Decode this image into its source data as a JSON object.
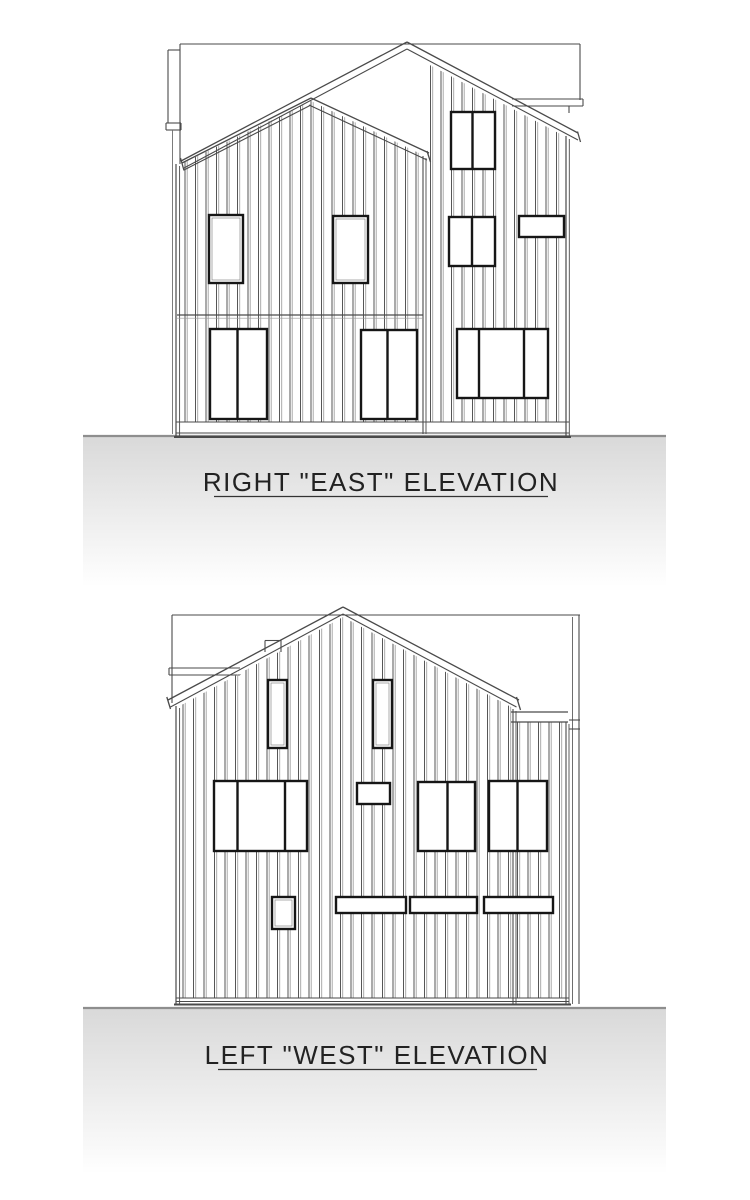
{
  "sheet": {
    "background": "#ffffff",
    "ink": "#4a4a4a",
    "frame_color": "#161616",
    "batten_dark": "#565656",
    "batten_light": "#a2a2a2",
    "ground_top_line": "#8e8e8e",
    "ground_fill_top": "#d9d9d9",
    "ground_fill_bottom": "#ffffff"
  },
  "elevations": [
    {
      "id": "east",
      "caption": "RIGHT \"EAST\" ELEVATION",
      "caption_pos": {
        "x": 381,
        "y": 491
      },
      "underline": [
        214,
        496.5,
        548,
        496.5
      ],
      "ground": {
        "x": 83,
        "y": 436,
        "w": 583,
        "h": 150
      },
      "back_lines": [
        [
          180,
          44,
          580,
          44
        ],
        [
          180,
          44,
          180,
          164
        ],
        [
          580,
          44,
          580,
          100
        ],
        [
          168,
          50,
          180,
          50
        ],
        [
          168,
          50,
          168,
          123
        ],
        [
          166,
          123,
          181,
          123
        ],
        [
          166,
          130,
          181,
          130
        ],
        [
          166,
          123,
          166,
          130
        ],
        [
          181,
          123,
          181,
          130
        ],
        [
          172.5,
          130,
          172.5,
          434,
          0.9,
          "#6e6e6e"
        ],
        [
          512,
          99,
          583,
          99
        ],
        [
          512,
          106,
          583,
          106
        ],
        [
          583,
          99,
          583,
          106
        ],
        [
          569,
          106,
          569,
          113
        ]
      ],
      "walls": [
        [
          [
            177,
            168
          ],
          [
            311,
            103
          ],
          [
            425,
            158
          ],
          [
            425,
            434
          ],
          [
            177,
            434
          ]
        ],
        [
          [
            314,
            99
          ],
          [
            407,
            51
          ],
          [
            566,
            136
          ],
          [
            566,
            434
          ],
          [
            425,
            434
          ],
          [
            425,
            150
          ]
        ]
      ],
      "siding": [
        {
          "clip": [
            [
              177,
              166
            ],
            [
              311,
              101
            ],
            [
              425,
              156
            ],
            [
              425,
              422
            ],
            [
              177,
              422
            ]
          ],
          "x0": 185,
          "x1": 419,
          "step": 10.5
        },
        {
          "clip": [
            [
              316,
              100
            ],
            [
              407,
              53
            ],
            [
              566,
              137
            ],
            [
              566,
              422
            ],
            [
              427,
              422
            ],
            [
              427,
              152
            ]
          ],
          "x0": 430.5,
          "x1": 562,
          "step": 10.5
        }
      ],
      "front_lines": [
        [
          181,
          161,
          407,
          42,
          1.3
        ],
        [
          184,
          168,
          407,
          49,
          1.1
        ],
        [
          407,
          42,
          578,
          133,
          1.3
        ],
        [
          407,
          49,
          578,
          140,
          1.1
        ],
        [
          577.5,
          131.5,
          580.5,
          142,
          1.3
        ],
        [
          182,
          163,
          311,
          98,
          1.3
        ],
        [
          184,
          170,
          311,
          105,
          1.1
        ],
        [
          311,
          98,
          429,
          153,
          1.3
        ],
        [
          309,
          105,
          427,
          160,
          1.1
        ],
        [
          427,
          151,
          430.5,
          162,
          1.3
        ],
        [
          180.5,
          158,
          184,
          170.5,
          1.3
        ],
        [
          176,
          164,
          176,
          437,
          1.2
        ],
        [
          179.6,
          166,
          179.6,
          437,
          0.9
        ],
        [
          566,
          136,
          566,
          437,
          1.2
        ],
        [
          569.3,
          139,
          569.3,
          437,
          0.9
        ],
        [
          423,
          156,
          423,
          434,
          1.1
        ],
        [
          426,
          158,
          426,
          434,
          0.9
        ],
        [
          177,
          315,
          423,
          315,
          1.3
        ],
        [
          177,
          318.2,
          423,
          318.2,
          0.7,
          "#999999"
        ],
        [
          176,
          422,
          569,
          422,
          1.1
        ],
        [
          176,
          433,
          569,
          433,
          1.1
        ],
        [
          174,
          437,
          571,
          437,
          2
        ]
      ],
      "windows": [
        {
          "x": 209,
          "y": 215,
          "w": 34,
          "h": 68
        },
        {
          "x": 333,
          "y": 216,
          "w": 35,
          "h": 67
        },
        {
          "x": 449,
          "y": 217,
          "w": 46,
          "h": 49,
          "divs": [
            472
          ]
        },
        {
          "x": 519,
          "y": 216,
          "w": 45,
          "h": 21
        },
        {
          "x": 451,
          "y": 112,
          "w": 44,
          "h": 57,
          "divs": [
            472.5
          ]
        },
        {
          "x": 210,
          "y": 329,
          "w": 57,
          "h": 90,
          "divs": [
            237.5
          ]
        },
        {
          "x": 361,
          "y": 330,
          "w": 56,
          "h": 89,
          "divs": [
            387.5
          ]
        },
        {
          "x": 457,
          "y": 329,
          "w": 91,
          "h": 69,
          "divs": [
            479,
            524
          ]
        }
      ]
    },
    {
      "id": "west",
      "caption": "LEFT \"WEST\" ELEVATION",
      "caption_pos": {
        "x": 377,
        "y": 1064
      },
      "underline": [
        218,
        1069.5,
        537,
        1069.5
      ],
      "ground": {
        "x": 83,
        "y": 1008,
        "w": 583,
        "h": 165
      },
      "back_lines": [
        [
          172,
          615,
          580,
          615
        ],
        [
          172,
          615,
          172,
          703
        ],
        [
          572.5,
          617,
          572.5,
          1004,
          1,
          "#6e6e6e"
        ],
        [
          579,
          615,
          579,
          1004
        ],
        [
          169,
          668,
          240,
          668
        ],
        [
          169,
          675,
          243,
          675
        ],
        [
          169,
          668,
          169,
          675
        ],
        [
          568,
          720,
          580,
          720
        ],
        [
          568,
          729,
          580,
          729
        ],
        [
          568,
          720,
          568,
          729
        ]
      ],
      "walls": [
        [
          [
            176,
            710
          ],
          [
            343,
            619
          ],
          [
            513,
            710
          ],
          [
            513,
            1004
          ],
          [
            176,
            1004
          ]
        ],
        [
          [
            513,
            712
          ],
          [
            569,
            712
          ],
          [
            569,
            1004
          ],
          [
            513,
            1004
          ]
        ]
      ],
      "siding": [
        {
          "clip": [
            [
              176,
              708
            ],
            [
              343,
              617
            ],
            [
              513,
              708
            ],
            [
              513,
              998
            ],
            [
              176,
              998
            ]
          ],
          "x0": 183,
          "x1": 510,
          "step": 10.5
        },
        {
          "clip": [
            [
              515,
              722
            ],
            [
              566,
              722
            ],
            [
              566,
              998
            ],
            [
              515,
              998
            ]
          ],
          "x0": 517.5,
          "x1": 564,
          "step": 10.5
        }
      ],
      "front_lines": [
        [
          168,
          700,
          343,
          607,
          1.3
        ],
        [
          170.5,
          707,
          343,
          614,
          1.1
        ],
        [
          343,
          607,
          519,
          700,
          1.3
        ],
        [
          343,
          614,
          516.5,
          707,
          1.1
        ],
        [
          166.8,
          697,
          170.5,
          709,
          1.3
        ],
        [
          516.5,
          697,
          520.5,
          710,
          1.3
        ],
        [
          265,
          640.5,
          281,
          640.5,
          1.1
        ],
        [
          265,
          640.5,
          265,
          652,
          1.1
        ],
        [
          281,
          640.5,
          281,
          652,
          1.1
        ],
        [
          511,
          712,
          568,
          712,
          1.2
        ],
        [
          511,
          722,
          568,
          722,
          1.2
        ],
        [
          513,
          709,
          513,
          1004,
          1.1
        ],
        [
          516,
          711,
          516,
          1004,
          0.9
        ],
        [
          566,
          722,
          566,
          1004,
          1.1
        ],
        [
          569,
          724,
          569,
          1004,
          0.9
        ],
        [
          176,
          706,
          176,
          1004,
          1.2
        ],
        [
          179.6,
          708,
          179.6,
          1004,
          0.9
        ],
        [
          176,
          998,
          569,
          998,
          1
        ],
        [
          176,
          1001.5,
          569,
          1001.5,
          0.9
        ],
        [
          174,
          1004.5,
          571,
          1004.5,
          2
        ]
      ],
      "windows": [
        {
          "x": 268,
          "y": 680,
          "w": 19,
          "h": 68
        },
        {
          "x": 373,
          "y": 680,
          "w": 19,
          "h": 68
        },
        {
          "x": 214,
          "y": 781,
          "w": 93,
          "h": 70,
          "divs": [
            237.5,
            285
          ]
        },
        {
          "x": 357,
          "y": 783,
          "w": 33,
          "h": 21
        },
        {
          "x": 418,
          "y": 782,
          "w": 57,
          "h": 69,
          "divs": [
            447.5
          ]
        },
        {
          "x": 489,
          "y": 781,
          "w": 58,
          "h": 70,
          "divs": [
            517.5
          ]
        },
        {
          "x": 272,
          "y": 897,
          "w": 23,
          "h": 32
        },
        {
          "x": 336,
          "y": 897,
          "w": 70,
          "h": 16
        },
        {
          "x": 410,
          "y": 897,
          "w": 67,
          "h": 16
        },
        {
          "x": 484,
          "y": 897,
          "w": 69,
          "h": 16
        }
      ]
    }
  ]
}
